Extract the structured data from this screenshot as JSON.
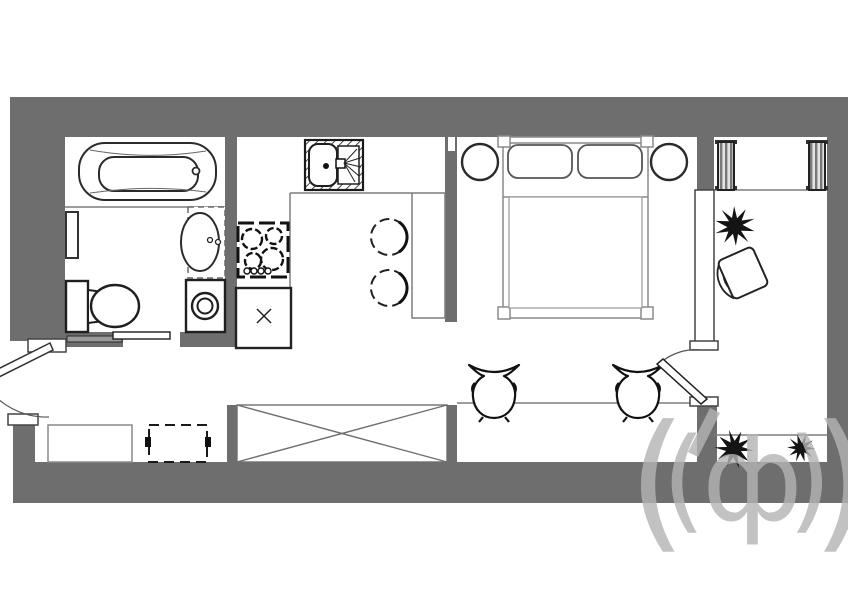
{
  "plan": {
    "kind": "studio-apartment-floor-plan",
    "colors": {
      "background": "#ffffff",
      "wall": "#6e6e6e",
      "outline_dark": "#1f1f1f",
      "outline_gray": "#808080",
      "plant": "#141414",
      "watermark": "#b4b4b4"
    },
    "watermark": {
      "glyphs": {
        "outer_left": "(",
        "inner_left": "(",
        "letter": "ф",
        "inner_right": ")",
        "outer_right": ")"
      }
    },
    "rooms": {
      "bathroom": {
        "fixtures": [
          "bathtub",
          "wall-radiator",
          "pedestal-sink",
          "toilet",
          "washing-machine",
          "sliding-door"
        ]
      },
      "kitchen": {
        "fixtures": [
          "kitchen-sink",
          "cooktop",
          "base-cabinet",
          "counter",
          "table",
          "chair",
          "chair"
        ]
      },
      "bedroom": {
        "fixtures": [
          "double-bed",
          "pillow",
          "pillow",
          "nightstand",
          "nightstand"
        ]
      },
      "hallway": {
        "fixtures": [
          "entrance-door",
          "bench",
          "dashed-cabinet",
          "wardrobe",
          "desk",
          "armchair",
          "armchair"
        ]
      },
      "balcony": {
        "fixtures": [
          "balcony-door",
          "radiator",
          "radiator",
          "plant",
          "armchair",
          "console",
          "plant",
          "plant"
        ]
      }
    }
  }
}
